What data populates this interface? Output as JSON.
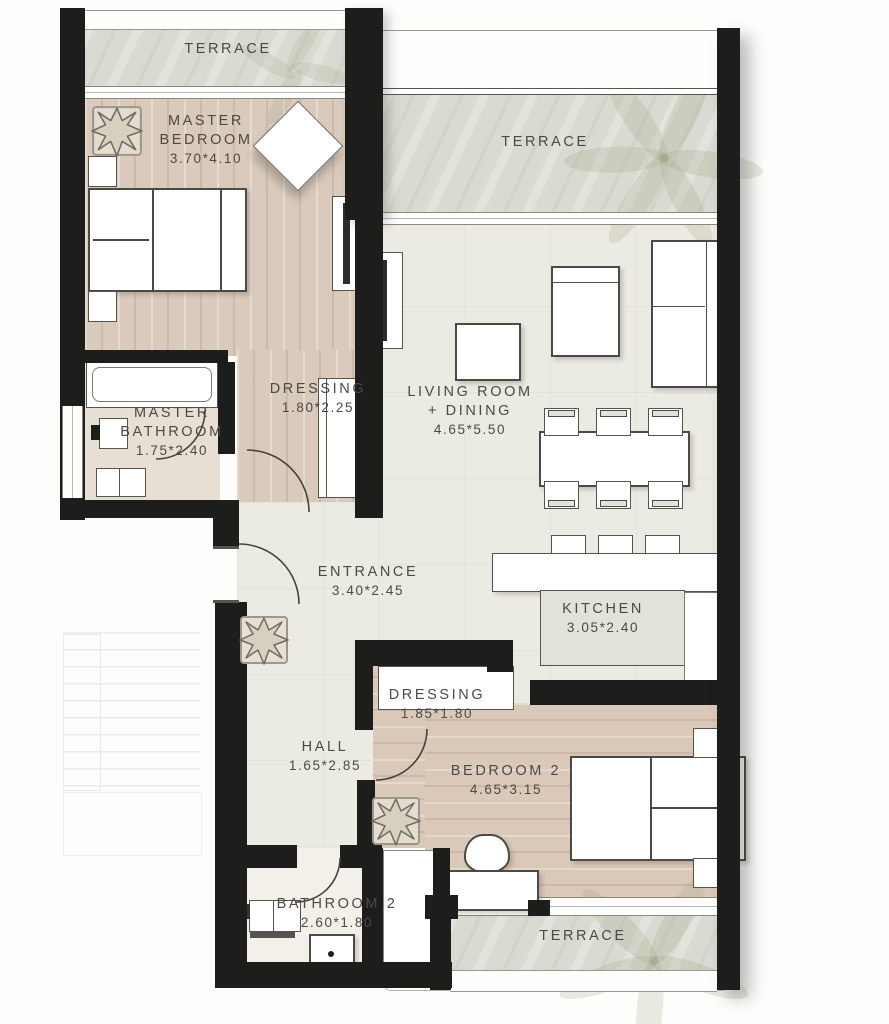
{
  "plan_title": "Apartment floor plan",
  "rooms": [
    {
      "id": "terrace-top-left",
      "lines": [
        "TERRACE"
      ]
    },
    {
      "id": "master-bedroom",
      "lines": [
        "MASTER",
        "BEDROOM",
        "3.70*4.10"
      ]
    },
    {
      "id": "terrace-living",
      "lines": [
        "TERRACE"
      ]
    },
    {
      "id": "dressing-master",
      "lines": [
        "DRESSING",
        "1.80*2.25"
      ]
    },
    {
      "id": "master-bathroom",
      "lines": [
        "MASTER",
        "BATHROOM",
        "1.75*2.40"
      ]
    },
    {
      "id": "living-dining",
      "lines": [
        "LIVING ROOM",
        "+ DINING",
        "4.65*5.50"
      ]
    },
    {
      "id": "entrance",
      "lines": [
        "ENTRANCE",
        "3.40*2.45"
      ]
    },
    {
      "id": "kitchen",
      "lines": [
        "KITCHEN",
        "3.05*2.40"
      ]
    },
    {
      "id": "dressing-2",
      "lines": [
        "DRESSING",
        "1.85*1.80"
      ]
    },
    {
      "id": "hall",
      "lines": [
        "HALL",
        "1.65*2.85"
      ]
    },
    {
      "id": "bedroom-2",
      "lines": [
        "BEDROOM 2",
        "4.65*3.15"
      ]
    },
    {
      "id": "bathroom-2",
      "lines": [
        "BATHROOM 2",
        "2.60*1.80"
      ]
    },
    {
      "id": "terrace-bottom",
      "lines": [
        "TERRACE"
      ]
    }
  ],
  "decor": {
    "plant_icon": "potted-plant-top-view",
    "palm_icon": "palm-leaves",
    "stairs_icon": "staircase-outline"
  },
  "colors": {
    "wall": "#1d1d1b",
    "wood_floor": "#d9cabb",
    "wood_floor_bedroom2": "#dac8b8",
    "terrace_floor": "#d9dad1",
    "interior_floor": "#ebeae3",
    "bathroom_floor": "#e7dfd4",
    "furniture_outline": "#4a4a46",
    "label_text": "#4b4a44",
    "decor_green": "#9ca07a"
  }
}
